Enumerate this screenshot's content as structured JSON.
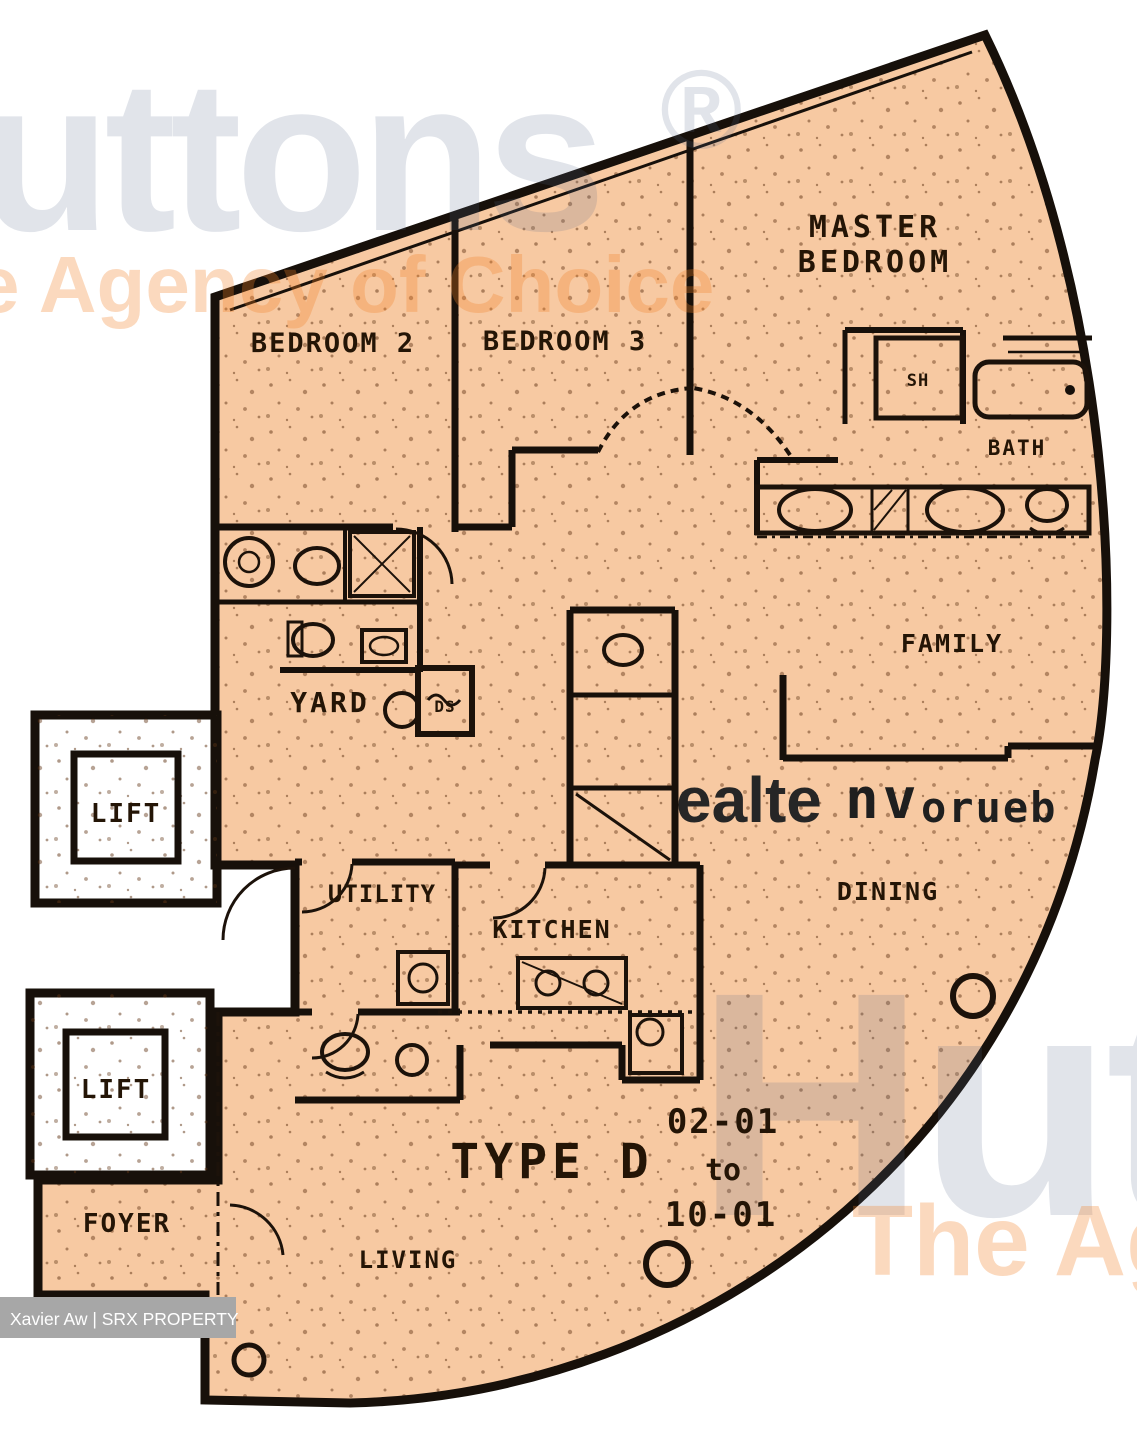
{
  "attribution": "Xavier Aw | SRX PROPERTY",
  "plan": {
    "type_label": "TYPE D",
    "unit_from": "02-01",
    "unit_connector": "to",
    "unit_to": "10-01"
  },
  "rooms": {
    "master1": "MASTER",
    "master2": "BEDROOM",
    "bedroom2": "BEDROOM 2",
    "bedroom3": "BEDROOM 3",
    "bath": "BATH",
    "shower": "SH",
    "family": "FAMILY",
    "dining": "DINING",
    "living": "LIVING",
    "kitchen": "KITCHEN",
    "utility": "UTILITY",
    "yard": "YARD",
    "ds": "DS",
    "foyer": "FOYER",
    "lift": "LIFT"
  },
  "watermarks": {
    "brand": "Huttons",
    "registered": "®",
    "tagline": "e Agency of Choice",
    "tagline_bottom": "The Ag",
    "stamp1": "ealte",
    "stamp2": "nv",
    "stamp3": "orueb"
  },
  "colors": {
    "plan_fill": "#f7c9a2",
    "wall": "#17100a",
    "watermark_gray": "#aebacd",
    "watermark_orange": "#f5a45f",
    "label_bar": "#a7a7a7"
  }
}
